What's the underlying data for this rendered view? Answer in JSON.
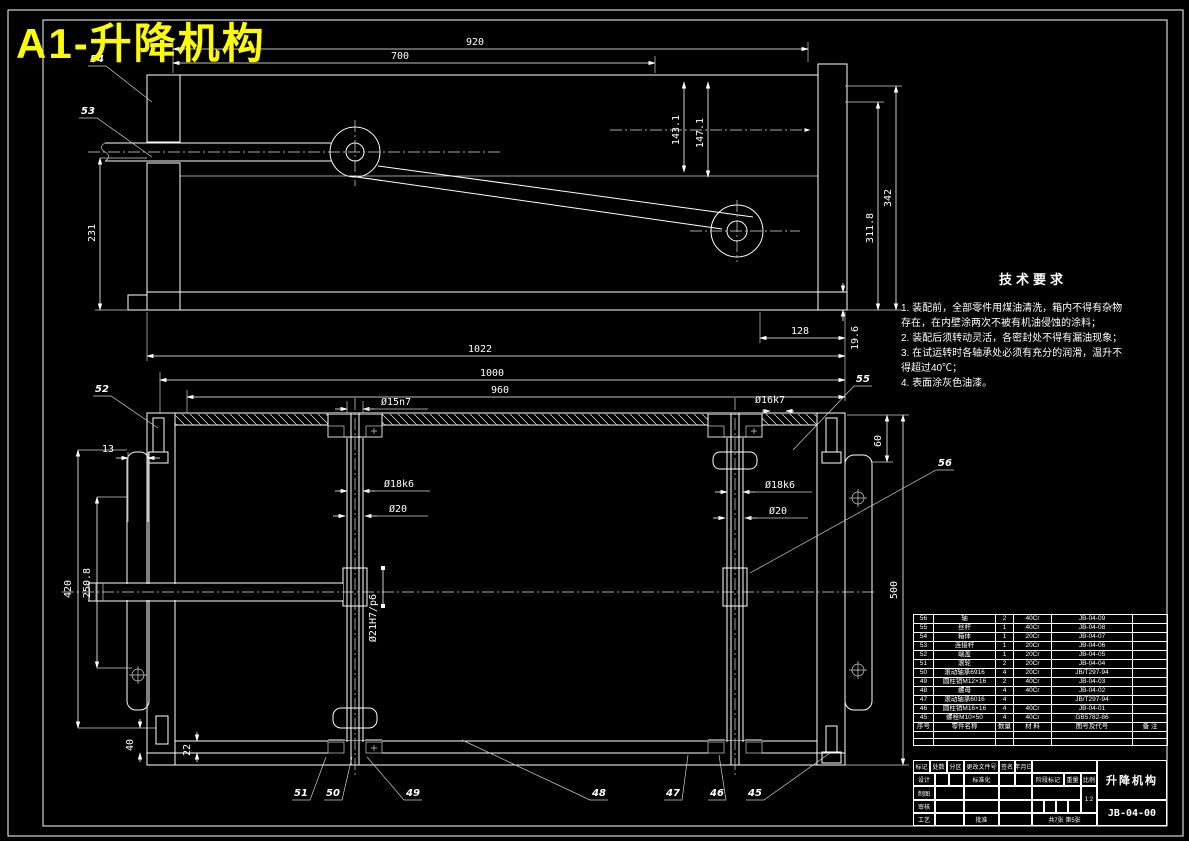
{
  "sheet": {
    "title": "A1-升降机构"
  },
  "tech": {
    "title": "技术要求",
    "lines": [
      "1. 装配前，全部零件用煤油清洗，箱内不得有杂物",
      "存在，在内壁涂两次不被有机油侵蚀的涂料；",
      "2. 装配后须转动灵活，各密封处不得有漏油现象；",
      "3. 在试运转时各轴承处必须有充分的润滑，温升不",
      "得超过40℃；",
      "4. 表面涂灰色油漆。"
    ]
  },
  "dims": {
    "d920": "920",
    "d700": "700",
    "d1431": "143.1",
    "d1471": "147.1",
    "d3118": "311.8",
    "d342": "342",
    "d231": "231",
    "d128": "128",
    "d196": "19.6",
    "d1022": "1022",
    "d1000": "1000",
    "d960": "960",
    "d15": "Ø15n7",
    "d16": "Ø16k7",
    "d18L": "Ø18k6",
    "d18R": "Ø18k6",
    "d20L": "Ø20",
    "d20R": "Ø20",
    "d21": "Ø21H7/p6",
    "d60": "60",
    "d500": "500",
    "d420": "420",
    "d2508": "250.8",
    "d13": "13",
    "d40": "40",
    "d22": "22"
  },
  "balloons": {
    "b45": "45",
    "b46": "46",
    "b47": "47",
    "b48": "48",
    "b49": "49",
    "b50": "50",
    "b51": "51",
    "b52": "52",
    "b53": "53",
    "b54": "54",
    "b55": "55",
    "b56": "56"
  },
  "parts_table": {
    "headers": [
      "序号",
      "零件名称",
      "数量",
      "材 料",
      "图号及代号",
      "备 注"
    ],
    "rows": [
      [
        "56",
        "轴",
        "2",
        "40Cr",
        "JB-04-09",
        ""
      ],
      [
        "55",
        "丝杆",
        "1",
        "40Cr",
        "JB-04-08",
        ""
      ],
      [
        "54",
        "箱体",
        "1",
        "20Cr",
        "JB-04-07",
        ""
      ],
      [
        "53",
        "连接杆",
        "1",
        "20Cr",
        "JB-04-06",
        ""
      ],
      [
        "52",
        "端盖",
        "1",
        "20Cr",
        "JB-04-05",
        ""
      ],
      [
        "51",
        "滚轮",
        "2",
        "20Cr",
        "JB-04-04",
        ""
      ],
      [
        "50",
        "滚动轴承6916",
        "4",
        "20Cr",
        "JB/T297-94",
        ""
      ],
      [
        "49",
        "圆柱销M12×16",
        "2",
        "40Cr",
        "JB-04-03",
        ""
      ],
      [
        "48",
        "螺母",
        "4",
        "40Cr",
        "JB-04-02",
        ""
      ],
      [
        "47",
        "滚动轴承6016",
        "4",
        "",
        "JB/T297-94",
        ""
      ],
      [
        "46",
        "圆柱销M16×16",
        "4",
        "40Cr",
        "JB-04-01",
        ""
      ],
      [
        "45",
        "螺栓M10×50",
        "4",
        "40Cr",
        "GB5782-86",
        ""
      ]
    ]
  },
  "title_block": {
    "mark": "标记",
    "count": "处数",
    "zone": "分区",
    "change_doc": "更改文件号",
    "sign": "签名",
    "date": "年月日",
    "design": "设计",
    "draw": "制图",
    "check": "审核",
    "process": "工艺",
    "standardization": "标准化",
    "approve": "批准",
    "stage_mark": "阶段标记",
    "weight": "重量",
    "scale": "比例",
    "scale_value": "1:2",
    "sheet_info": "共7张 第5张",
    "part_name": "升降机构",
    "drawing_no": "JB-04-00"
  }
}
